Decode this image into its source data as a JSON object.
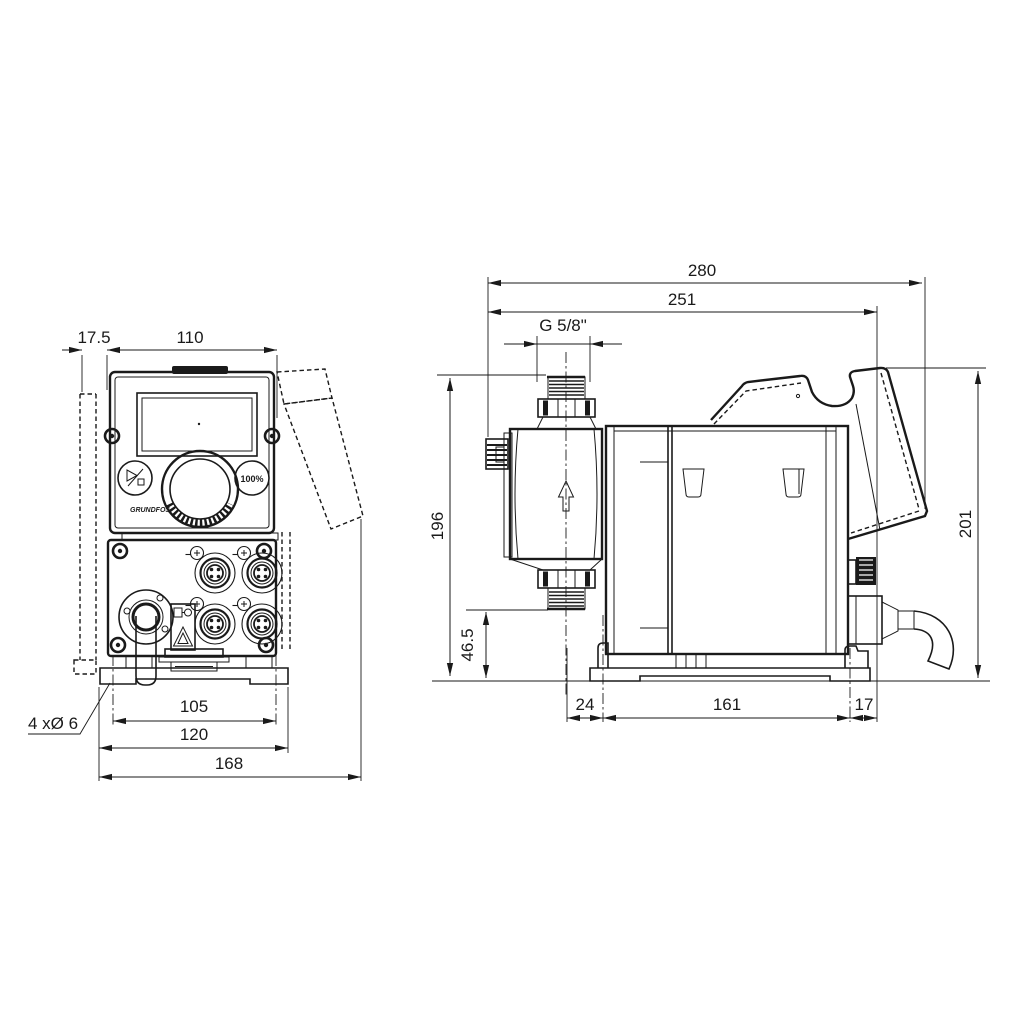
{
  "dimensions": {
    "overall_width": "280",
    "width_to_base_end": "251",
    "connection_thread": "G 5/8\"",
    "wall_plate_depth": "17.5",
    "front_width": "110",
    "inlet_height": "196",
    "outlet_height": "46.5",
    "overall_height": "201",
    "base_offset_front": "24",
    "base_hole_spacing": "161",
    "base_offset_rear": "17",
    "mounting_holes": "4 xØ 6",
    "foot_hole_spacing": "105",
    "foot_width": "120",
    "overall_depth": "168"
  },
  "control_panel": {
    "capacity_button": "100%",
    "brand": "GRUNDFOS"
  },
  "icons": {
    "start_stop_button": "play-stop-icon",
    "flow_direction": "arrow-up-icon",
    "warning_label": "warning-triangle-icon",
    "electrical_label": "plug-icon"
  }
}
